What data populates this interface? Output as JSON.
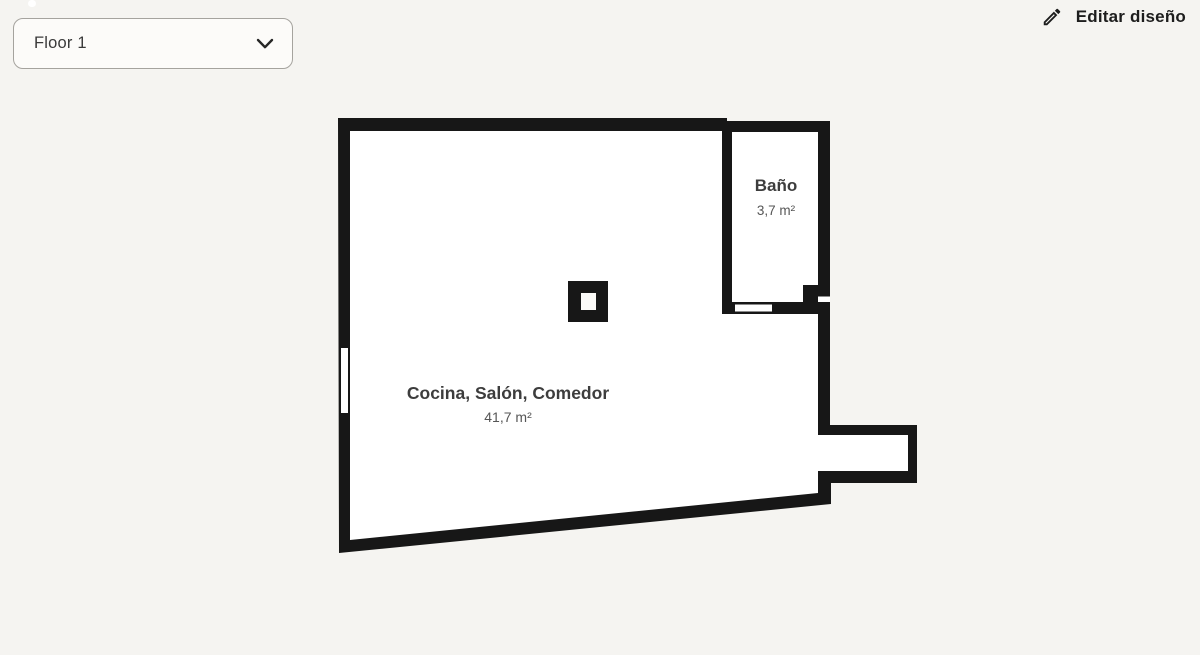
{
  "header": {
    "floor_selector": {
      "value": "Floor 1",
      "icon": "chevron-down-icon"
    },
    "edit_button": {
      "label": "Editar diseño",
      "icon": "pencil-icon"
    }
  },
  "floor_plan": {
    "rooms": [
      {
        "name": "Cocina, Salón, Comedor",
        "area": "41,7 m²"
      },
      {
        "name": "Baño",
        "area": "3,7 m²"
      }
    ],
    "features": [
      "pillar",
      "bathroom-door",
      "left-wall-window",
      "right-wall-gap",
      "alcove"
    ]
  },
  "colors": {
    "page_background": "#f5f4f1",
    "wall": "#171717",
    "floor": "#ffffff",
    "room_name_text": "#3d3d3d",
    "room_area_text": "#565656",
    "dropdown_background": "#fcfbf9",
    "dropdown_border": "#a5a39e",
    "button_text": "#1d1d1d"
  }
}
